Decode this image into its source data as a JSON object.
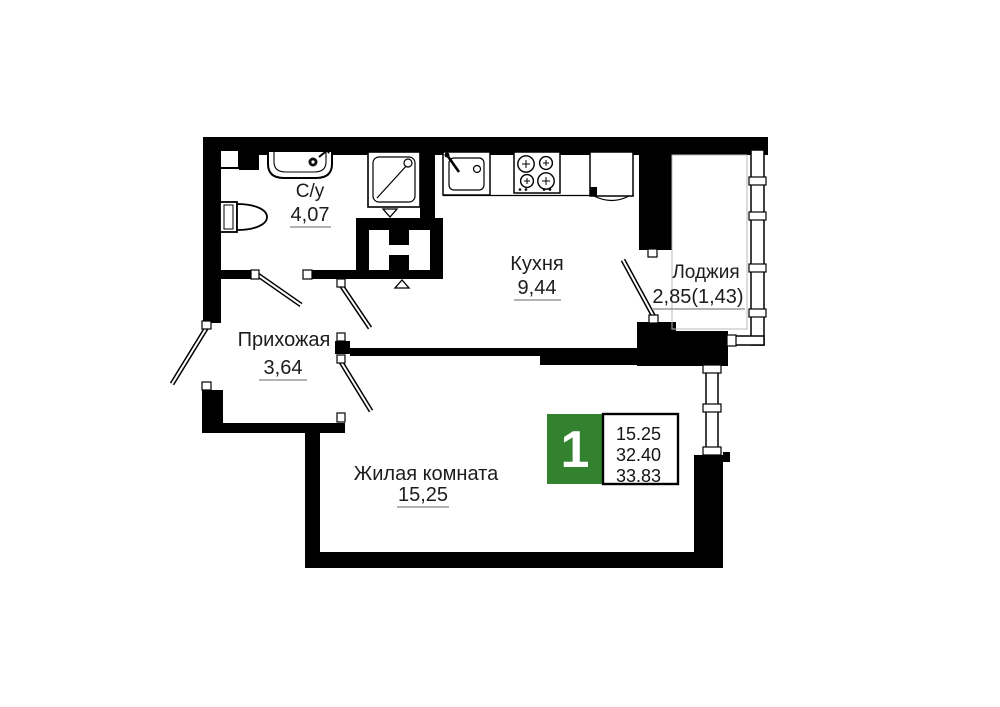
{
  "plan_type": "apartment-floor-plan",
  "rooms": [
    {
      "name": "С/у",
      "area": "4,07"
    },
    {
      "name": "Кухня",
      "area": "9,44"
    },
    {
      "name": "Лоджия",
      "area": "2,85(1,43)"
    },
    {
      "name": "Прихожая",
      "area": "3,64"
    },
    {
      "name": "Жилая комната",
      "area": "15,25"
    }
  ],
  "badge": {
    "rooms_count": "1",
    "living_area": "15.25",
    "area_without_loggia": "32.40",
    "total_area": "33.83",
    "accent_color": "#338230"
  },
  "colors": {
    "wall": "#000000",
    "background": "#ffffff",
    "underline": "#9a9a9a"
  },
  "icons": {
    "fixtures": [
      "washbasin-icon",
      "toilet-icon",
      "shower-icon",
      "kitchen-sink-icon",
      "stove-icon",
      "fridge-icon"
    ],
    "symbols": [
      "door-swing",
      "door-hinge",
      "window-glazing",
      "vent-triangle"
    ]
  }
}
